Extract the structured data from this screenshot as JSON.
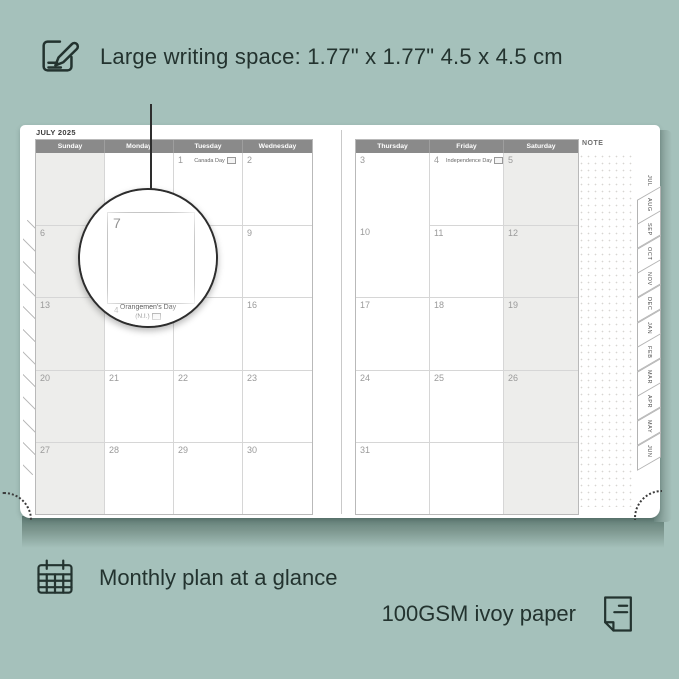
{
  "colors": {
    "background": "#a5c1bb",
    "cover_edge": "#5e7b74",
    "header_bar": "#8a8a8a",
    "ink": "#23332f",
    "shaded_cell": "#ededeb"
  },
  "callouts": {
    "writing_space": "Large writing space: 1.77\" x 1.77\"  4.5 x 4.5 cm",
    "monthly_plan": "Monthly plan at a glance",
    "paper": "100GSM ivoy paper"
  },
  "planner": {
    "month_title": "JULY 2025",
    "note_label": "NOTE",
    "left_page": {
      "headers": [
        "Sunday",
        "Monday",
        "Tuesday",
        "Wednesday"
      ],
      "rows": [
        [
          {
            "day": ""
          },
          {
            "day": ""
          },
          {
            "day": "1",
            "holiday": "Canada Day"
          },
          {
            "day": "2"
          }
        ],
        [
          {
            "day": "6"
          },
          {
            "day": "7"
          },
          {
            "day": "8"
          },
          {
            "day": "9"
          }
        ],
        [
          {
            "day": "13"
          },
          {
            "day": "14",
            "holiday": "Orangemen's Day (N.I.)"
          },
          {
            "day": "15"
          },
          {
            "day": "16"
          }
        ],
        [
          {
            "day": "20"
          },
          {
            "day": "21"
          },
          {
            "day": "22"
          },
          {
            "day": "23"
          }
        ],
        [
          {
            "day": "27"
          },
          {
            "day": "28"
          },
          {
            "day": "29"
          },
          {
            "day": "30"
          }
        ]
      ]
    },
    "right_page": {
      "headers": [
        "Thursday",
        "Friday",
        "Saturday"
      ],
      "rows": [
        [
          {
            "day": "3"
          },
          {
            "day": "4",
            "holiday": "Independence Day"
          },
          {
            "day": "5"
          }
        ],
        [
          {
            "day": "10"
          },
          {
            "day": "11"
          },
          {
            "day": "12"
          }
        ],
        [
          {
            "day": "17"
          },
          {
            "day": "18"
          },
          {
            "day": "19"
          }
        ],
        [
          {
            "day": "24"
          },
          {
            "day": "25"
          },
          {
            "day": "26"
          }
        ],
        [
          {
            "day": "31"
          },
          {
            "day": ""
          },
          {
            "day": ""
          }
        ]
      ]
    },
    "tabs": [
      "JUL",
      "AUG",
      "SEP",
      "OCT",
      "NOV",
      "DEC",
      "JAN",
      "FEB",
      "MAR",
      "APR",
      "MAY",
      "JUN"
    ],
    "magnifier": {
      "day": "7",
      "partial_day": "4",
      "holiday_line1": "Orangemen's Day",
      "holiday_line2": "(N.I.)"
    }
  }
}
